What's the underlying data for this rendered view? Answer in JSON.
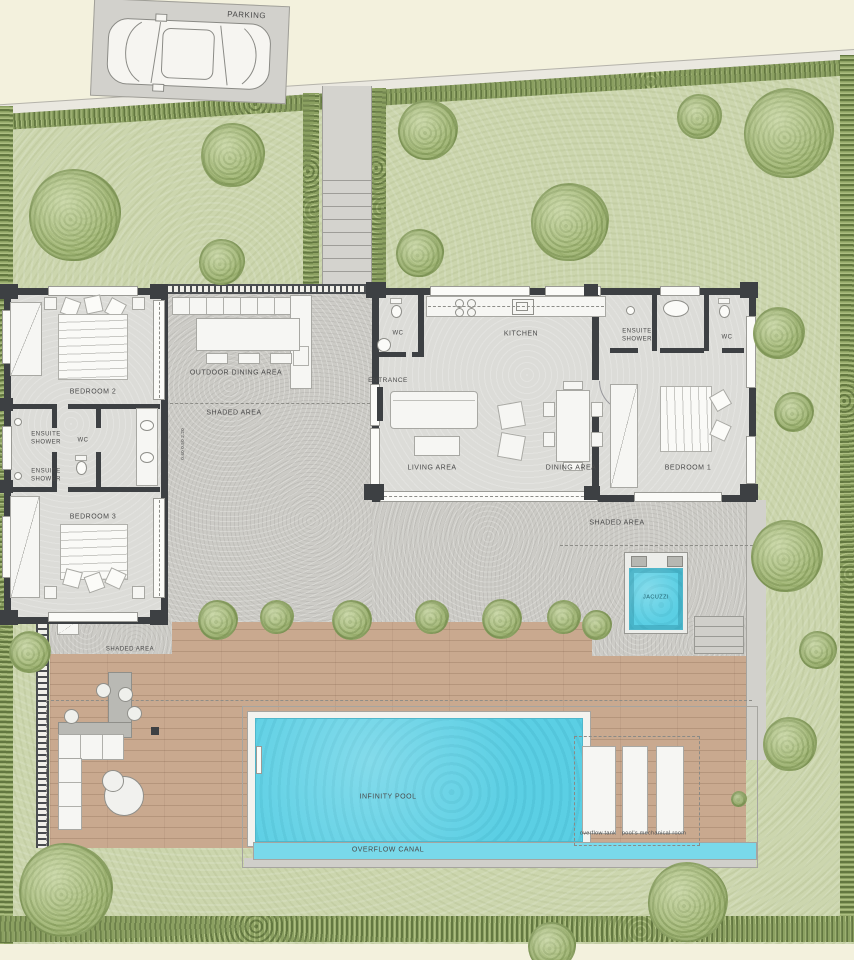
{
  "title": "Villa ground floor site plan",
  "labels": {
    "parking": "PARKING",
    "bedroom_2": "BEDROOM 2",
    "bedroom_3": "BEDROOM 3",
    "bedroom_1": "BEDROOM 1",
    "ensuite_shower_left_top": "ENSUITE SHOWER",
    "ensuite_shower_left_bottom": "ENSUITE SHOWER",
    "ensuite_shower_right": "ENSUITE SHOWER",
    "wc_left": "WC",
    "wc_main": "WC",
    "wc_right": "WC",
    "kitchen": "KITCHEN",
    "entrance": "ENTRANCE",
    "living_area": "LIVING AREA",
    "dining_area": "DINING AREA",
    "outdoor_dining_area": "OUTDOOR DINING AREA",
    "shaded_area_terrace": "SHADED AREA",
    "shaded_area_right": "SHADED AREA",
    "shaded_area_deck": "SHADED AREA",
    "jacuzzi": "JACUZZI",
    "infinity_pool": "INFINITY POOL",
    "overflow_canal": "OVERFLOW CANAL",
    "overflow_tank": "overflow tank",
    "pool_mechanical_room": "pool's mechanical room",
    "window_dimension": "0.40 0.50 2.20"
  },
  "colors": {
    "wall": "#3d4043",
    "pool_water": "#5bcfe4",
    "lawn": "#ccd6ae",
    "hedge": "#8ba061",
    "deck_wood": "#c9a98f",
    "concrete": "#cccbc6",
    "interior_floor": "#dcdcd8",
    "street": "#f3f1dd"
  }
}
